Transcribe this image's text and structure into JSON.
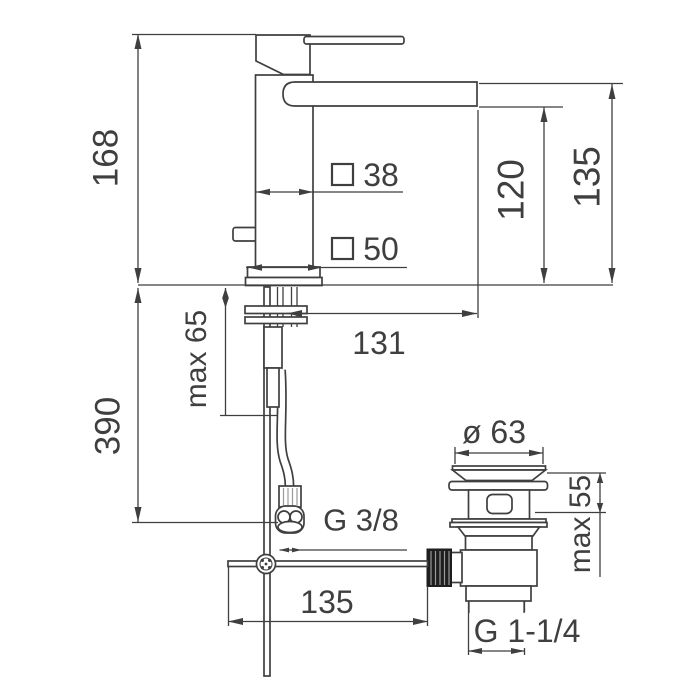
{
  "dimensions": {
    "total_height": "168",
    "below_deck_height": "390",
    "deck_thickness_max": "max 65",
    "spout_underside_height": "120",
    "spout_top_height": "135",
    "body_square_width": "38",
    "base_square_width": "50",
    "spout_reach": "131",
    "hose_thread": "G 3/8",
    "rod_reach": "135",
    "waste_flange_diameter": "ø 63",
    "waste_deck_max": "max 55",
    "waste_thread": "G 1-1/4"
  }
}
